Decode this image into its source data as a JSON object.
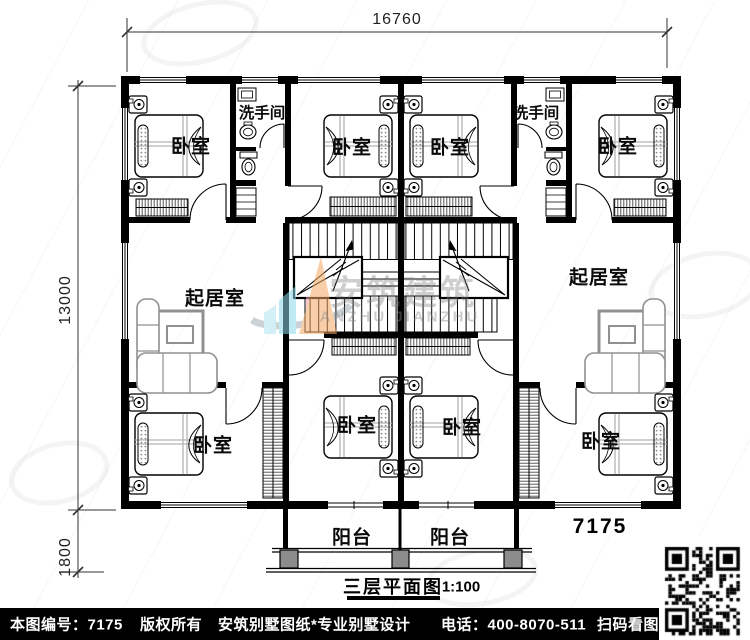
{
  "dimensions": {
    "width_top": "16760",
    "height_main": "13000",
    "height_balcony": "1800"
  },
  "room_labels": {
    "bedroom": "卧室",
    "bathroom": "洗手间",
    "living_room": "起居室",
    "balcony": "阳台"
  },
  "plan": {
    "number": "7175",
    "title": "三层平面图",
    "scale": "1:100"
  },
  "watermark": {
    "cn": "安筑建筑",
    "en": "ANZHU JIANZHU"
  },
  "footer": {
    "drawing_no": "本图编号：7175",
    "copyright": "版权所有",
    "company": "安筑别墅图纸*专业别墅设计",
    "phone": "电话：400-8070-511",
    "scan_hint": "扫码看图"
  },
  "colors": {
    "wall": "#000000",
    "footer_bg": "#000000",
    "accent_orange": "#f4a963",
    "accent_cyan": "#8ed9ea",
    "accent_pink": "#f29bb6",
    "column_gray": "#8c8c8c"
  }
}
